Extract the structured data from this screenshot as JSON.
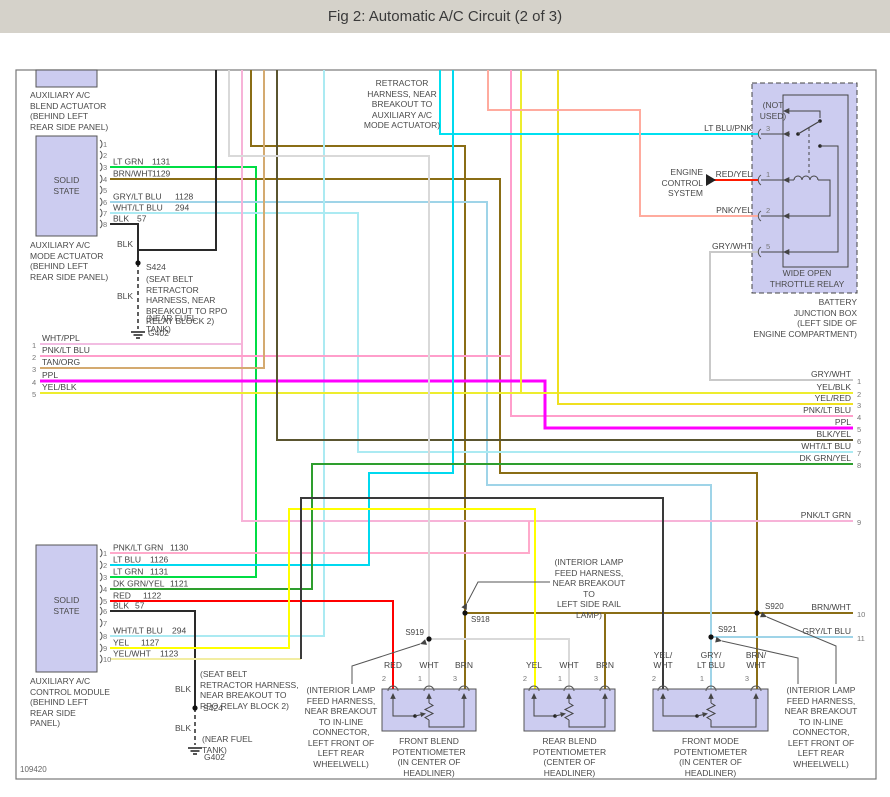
{
  "title": "Fig 2: Automatic A/C Circuit (2 of 3)",
  "doc_id": "109420",
  "colors": {
    "titlebar": "#d5d2ca",
    "box_fill": "#ccccf0",
    "box_border": "#555555",
    "text": "#4a4a4a",
    "frame": "#666666",
    "lt_grn": "#00dd44",
    "brn": "#8a6d15",
    "gry_lt_blu": "#9fd4e8",
    "wht_lt_blu": "#abeaf2",
    "blk": "#2a2a2a",
    "wht_ppl": "#f2bde2",
    "pnk_lt_blu": "#ff9ecb",
    "tan_org": "#d4aa70",
    "ppl": "#ff00ff",
    "yel_blk": "#eded2e",
    "yel_red": "#efe020",
    "blk_yel": "#5a5530",
    "gry_wht": "#c9c9c9",
    "lt_blu_pnk": "#00e0f0",
    "pnk_yel": "#ffab9e",
    "red": "#ff0000",
    "wht": "#d9d9d9",
    "lt_blu": "#00d9ef",
    "dk_grn_yel": "#2e9e2e",
    "yel": "#ffff00",
    "yel_wht": "#f2eda2",
    "pnk_lt_grn": "#ffaacb"
  },
  "components": {
    "blend_actuator": {
      "label": "AUXILIARY A/C\nBLEND ACTUATOR\n(BEHIND LEFT\nREAR SIDE PANEL)"
    },
    "mode_actuator": {
      "solid_state": "SOLID\nSTATE",
      "label": "AUXILIARY A/C\nMODE ACTUATOR\n(BEHIND LEFT\nREAR SIDE PANEL)",
      "pins": [
        {
          "n": "1",
          "y": 144,
          "label": "",
          "circuit": "",
          "cx": 0
        },
        {
          "n": "2",
          "y": 155,
          "label": "",
          "circuit": "",
          "cx": 0
        },
        {
          "n": "3",
          "y": 167,
          "label": "LT GRN",
          "circuit": "1131",
          "cx": 152
        },
        {
          "n": "4",
          "y": 179,
          "label": "BRN/WHT",
          "circuit": "1129",
          "cx": 152
        },
        {
          "n": "5",
          "y": 190,
          "label": "",
          "circuit": "",
          "cx": 0
        },
        {
          "n": "6",
          "y": 202,
          "label": "GRY/LT BLU",
          "circuit": "1128",
          "cx": 175
        },
        {
          "n": "7",
          "y": 213,
          "label": "WHT/LT BLU",
          "circuit": "294",
          "cx": 175
        },
        {
          "n": "8",
          "y": 224,
          "label": "BLK",
          "circuit": "57",
          "cx": 137
        }
      ]
    },
    "control_module": {
      "solid_state": "SOLID\nSTATE",
      "label": "AUXILIARY A/C\nCONTROL MODULE\n(BEHIND LEFT\nREAR SIDE\nPANEL)",
      "pins": [
        {
          "n": "1",
          "y": 553,
          "label": "PNK/LT GRN",
          "circuit": "1130",
          "cx": 170
        },
        {
          "n": "2",
          "y": 565,
          "label": "LT BLU",
          "circuit": "1126",
          "cx": 150
        },
        {
          "n": "3",
          "y": 577,
          "label": "LT GRN",
          "circuit": "1131",
          "cx": 150
        },
        {
          "n": "4",
          "y": 589,
          "label": "DK GRN/YEL",
          "circuit": "1121",
          "cx": 170
        },
        {
          "n": "5",
          "y": 601,
          "label": "RED",
          "circuit": "1122",
          "cx": 143
        },
        {
          "n": "6",
          "y": 611,
          "label": "BLK",
          "circuit": "57",
          "cx": 135
        },
        {
          "n": "7",
          "y": 623,
          "label": "",
          "circuit": "",
          "cx": 0
        },
        {
          "n": "8",
          "y": 636,
          "label": "WHT/LT BLU",
          "circuit": "294",
          "cx": 172
        },
        {
          "n": "9",
          "y": 648,
          "label": "YEL",
          "circuit": "1127",
          "cx": 141
        },
        {
          "n": "10",
          "y": 659,
          "label": "YEL/WHT",
          "circuit": "1123",
          "cx": 160
        }
      ]
    },
    "relay": {
      "name": "WIDE OPEN\nTHROTTLE RELAY",
      "location": "BATTERY\nJUNCTION BOX\n(LEFT SIDE OF\nENGINE COMPARTMENT)",
      "not_used": "(NOT\nUSED)",
      "pins": [
        {
          "n": "3",
          "y": 134,
          "label": "LT BLU/PNK"
        },
        {
          "n": "1",
          "y": 180,
          "label": "RED/YEL"
        },
        {
          "n": "2",
          "y": 216,
          "label": "PNK/YEL"
        },
        {
          "n": "5",
          "y": 252,
          "label": "GRY/WHT"
        }
      ]
    },
    "pots": [
      {
        "x": 382,
        "w": 94,
        "label": "FRONT BLEND\nPOTENTIOMETER\n(IN CENTER OF\nHEADLINER)",
        "pins": [
          {
            "n": "2",
            "x": 393,
            "label": "RED"
          },
          {
            "n": "1",
            "x": 429,
            "label": "WHT"
          },
          {
            "n": "3",
            "x": 464,
            "label": "BRN"
          }
        ]
      },
      {
        "x": 524,
        "w": 91,
        "label": "REAR BLEND\nPOTENTIOMETER\n(CENTER OF\nHEADLINER)",
        "pins": [
          {
            "n": "2",
            "x": 534,
            "label": "YEL"
          },
          {
            "n": "1",
            "x": 569,
            "label": "WHT"
          },
          {
            "n": "3",
            "x": 605,
            "label": "BRN"
          }
        ]
      },
      {
        "x": 653,
        "w": 115,
        "label": "FRONT MODE\nPOTENTIOMETER\n(IN CENTER OF\nHEADLINER)",
        "pins": [
          {
            "n": "2",
            "x": 663,
            "label": "YEL/\nWHT"
          },
          {
            "n": "1",
            "x": 711,
            "label": "GRY/\nLT BLU"
          },
          {
            "n": "3",
            "x": 756,
            "label": "BRN/\nWHT"
          }
        ]
      }
    ]
  },
  "notes": {
    "retractor": "RETRACTOR\nHARNESS, NEAR\nBREAKOUT TO\nAUXILIARY A/C\nMODE ACTUATOR)",
    "seatbelt_upper": "(SEAT BELT RETRACTOR\nHARNESS, NEAR\nBREAKOUT TO RPO\nRELAY BLOCK 2)",
    "seatbelt_lower": "(SEAT BELT\nRETRACTOR HARNESS,\nNEAR BREAKOUT TO\nRPO RELAY BLOCK 2)",
    "near_fuel_tank": "(NEAR FUEL\nTANK)",
    "interior_lamp_left": "(INTERIOR LAMP\nFEED HARNESS,\nNEAR BREAKOUT\nTO IN-LINE\nCONNECTOR,\nLEFT FRONT OF\nLEFT REAR\nWHEELWELL)",
    "interior_lamp_rail": "(INTERIOR LAMP\nFEED HARNESS,\nNEAR BREAKOUT TO\nLEFT SIDE RAIL\nLAMP)",
    "interior_lamp_right": "(INTERIOR LAMP\nFEED HARNESS,\nNEAR BREAKOUT\nTO IN-LINE\nCONNECTOR,\nLEFT FRONT OF\nLEFT REAR\nWHEELWELL)",
    "engine_control": "ENGINE\nCONTROL\nSYSTEM",
    "blk": "BLK",
    "s424": "S424",
    "g402": "G402"
  },
  "left_pins": [
    {
      "n": "1",
      "y": 344,
      "label": "WHT/PPL"
    },
    {
      "n": "2",
      "y": 356,
      "label": "PNK/LT BLU"
    },
    {
      "n": "3",
      "y": 368,
      "label": "TAN/ORG"
    },
    {
      "n": "4",
      "y": 381,
      "label": "PPL"
    },
    {
      "n": "5",
      "y": 393,
      "label": "YEL/BLK"
    }
  ],
  "right_pins": [
    {
      "n": "1",
      "y": 380,
      "label": "GRY/WHT"
    },
    {
      "n": "2",
      "y": 393,
      "label": "YEL/BLK"
    },
    {
      "n": "3",
      "y": 404,
      "label": "YEL/RED"
    },
    {
      "n": "4",
      "y": 416,
      "label": "PNK/LT BLU"
    },
    {
      "n": "5",
      "y": 428,
      "label": "PPL"
    },
    {
      "n": "6",
      "y": 440,
      "label": "BLK/YEL"
    },
    {
      "n": "7",
      "y": 452,
      "label": "WHT/LT BLU"
    },
    {
      "n": "8",
      "y": 464,
      "label": "DK GRN/YEL"
    },
    {
      "n": "9",
      "y": 521,
      "label": "PNK/LT GRN"
    },
    {
      "n": "10",
      "y": 613,
      "label": "BRN/WHT"
    },
    {
      "n": "11",
      "y": 637,
      "label": "GRY/LT BLU"
    }
  ],
  "splices": [
    {
      "id": "S919",
      "x": 429,
      "y": 639,
      "lx": 424,
      "ly": 635,
      "anchor": "end"
    },
    {
      "id": "S918",
      "x": 465,
      "y": 613,
      "lx": 471,
      "ly": 622,
      "anchor": "start"
    },
    {
      "id": "S920",
      "x": 757,
      "y": 613,
      "lx": 765,
      "ly": 609,
      "anchor": "start"
    },
    {
      "id": "S921",
      "x": 711,
      "y": 637,
      "lx": 718,
      "ly": 632,
      "anchor": "start"
    },
    {
      "id": "S424",
      "x": 138,
      "y": 263,
      "lx": 0,
      "ly": 0,
      "anchor": "none"
    },
    {
      "id": "S424",
      "x": 195,
      "y": 708,
      "lx": 0,
      "ly": 0,
      "anchor": "none"
    }
  ],
  "grounds": [
    {
      "id": "G402",
      "x": 138,
      "y": 332
    },
    {
      "id": "G402",
      "x": 195,
      "y": 748
    }
  ],
  "wires": [
    {
      "name": "lt-grn-1131",
      "color": "#00dd44",
      "w": 2,
      "pts": [
        [
          110,
          167
        ],
        [
          256,
          167
        ],
        [
          256,
          577
        ],
        [
          110,
          577
        ]
      ]
    },
    {
      "name": "brn-retractor",
      "color": "#8a6d15",
      "w": 2,
      "pts": [
        [
          251,
          70
        ],
        [
          251,
          146
        ],
        [
          465,
          146
        ],
        [
          465,
          689
        ]
      ]
    },
    {
      "name": "brn-wht-1129",
      "color": "#8a6d15",
      "w": 2,
      "pts": [
        [
          110,
          179
        ],
        [
          500,
          179
        ],
        [
          500,
          473
        ],
        [
          757,
          473
        ],
        [
          757,
          689
        ]
      ]
    },
    {
      "name": "brn-splice-bus",
      "color": "#8a6d15",
      "w": 2,
      "pts": [
        [
          465,
          613
        ],
        [
          757,
          613
        ]
      ]
    },
    {
      "name": "brn-pot2",
      "color": "#8a6d15",
      "w": 2,
      "pts": [
        [
          605,
          613
        ],
        [
          605,
          689
        ]
      ]
    },
    {
      "name": "brn-wht-pin10",
      "color": "#8a6d15",
      "w": 2,
      "pts": [
        [
          757,
          613
        ],
        [
          853,
          613
        ]
      ]
    },
    {
      "name": "gry-lt-blu-1128",
      "color": "#9fd4e8",
      "w": 2,
      "pts": [
        [
          110,
          202
        ],
        [
          487,
          202
        ],
        [
          487,
          485
        ],
        [
          711,
          485
        ],
        [
          711,
          689
        ]
      ]
    },
    {
      "name": "gry-lt-blu-pin11",
      "color": "#9fd4e8",
      "w": 2,
      "pts": [
        [
          711,
          637
        ],
        [
          853,
          637
        ]
      ]
    },
    {
      "name": "wht-lt-blu-294-top",
      "color": "#abeaf2",
      "w": 2,
      "pts": [
        [
          110,
          213
        ],
        [
          358,
          213
        ],
        [
          358,
          452
        ],
        [
          853,
          452
        ]
      ]
    },
    {
      "name": "wht-lt-blu-294-module",
      "color": "#abeaf2",
      "w": 2,
      "pts": [
        [
          324,
          70
        ],
        [
          324,
          636
        ],
        [
          110,
          636
        ]
      ]
    },
    {
      "name": "blk-57-mode",
      "color": "#2a2a2a",
      "w": 2,
      "pts": [
        [
          110,
          224
        ],
        [
          138,
          224
        ],
        [
          138,
          263
        ]
      ]
    },
    {
      "name": "blk-blend",
      "color": "#2a2a2a",
      "w": 2,
      "pts": [
        [
          216,
          70
        ],
        [
          216,
          250
        ],
        [
          138,
          250
        ],
        [
          138,
          263
        ]
      ]
    },
    {
      "name": "blk-to-g402-rear",
      "color": "#2a2a2a",
      "w": 1.5,
      "dash": "4 3",
      "pts": [
        [
          138,
          263
        ],
        [
          138,
          329
        ]
      ]
    },
    {
      "name": "wht-ppl",
      "color": "#f2bde2",
      "w": 2,
      "pts": [
        [
          40,
          344
        ],
        [
          242,
          344
        ]
      ]
    },
    {
      "name": "wht-ppl-vert-pin9",
      "color": "#f7b3d8",
      "w": 2,
      "pts": [
        [
          242,
          70
        ],
        [
          242,
          521
        ],
        [
          853,
          521
        ]
      ]
    },
    {
      "name": "pnk-lt-grn-1130",
      "color": "#ffaacb",
      "w": 2,
      "pts": [
        [
          110,
          553
        ],
        [
          529,
          553
        ],
        [
          529,
          521
        ]
      ]
    },
    {
      "name": "pnk-lt-blu",
      "color": "#ff9ecb",
      "w": 2,
      "pts": [
        [
          40,
          356
        ],
        [
          511,
          356
        ],
        [
          511,
          416
        ],
        [
          853,
          416
        ]
      ]
    },
    {
      "name": "pnk-lt-blu-vert",
      "color": "#ff9ecb",
      "w": 2,
      "pts": [
        [
          511,
          70
        ],
        [
          511,
          356
        ]
      ]
    },
    {
      "name": "tan-org",
      "color": "#d4aa70",
      "w": 2,
      "pts": [
        [
          40,
          368
        ],
        [
          264,
          368
        ],
        [
          264,
          70
        ]
      ]
    },
    {
      "name": "ppl",
      "color": "#ff00ff",
      "w": 3,
      "pts": [
        [
          40,
          381
        ],
        [
          545,
          381
        ],
        [
          545,
          428
        ],
        [
          853,
          428
        ]
      ]
    },
    {
      "name": "yel-blk",
      "color": "#eded2e",
      "w": 2,
      "pts": [
        [
          40,
          393
        ],
        [
          853,
          393
        ]
      ]
    },
    {
      "name": "yel-blk-vert",
      "color": "#eded2e",
      "w": 2,
      "pts": [
        [
          521,
          70
        ],
        [
          521,
          393
        ]
      ]
    },
    {
      "name": "yel-red",
      "color": "#efe020",
      "w": 2,
      "pts": [
        [
          558,
          70
        ],
        [
          558,
          404
        ],
        [
          853,
          404
        ]
      ]
    },
    {
      "name": "blk-yel",
      "color": "#5a5530",
      "w": 2,
      "pts": [
        [
          277,
          70
        ],
        [
          277,
          440
        ],
        [
          853,
          440
        ]
      ]
    },
    {
      "name": "gry-wht-relay",
      "color": "#c9c9c9",
      "w": 2,
      "pts": [
        [
          758,
          252
        ],
        [
          710,
          252
        ],
        [
          710,
          380
        ],
        [
          853,
          380
        ]
      ]
    },
    {
      "name": "lt-blu-pnk",
      "color": "#00e0f0",
      "w": 2,
      "pts": [
        [
          440,
          70
        ],
        [
          440,
          134
        ],
        [
          758,
          134
        ]
      ]
    },
    {
      "name": "pnk-yel",
      "color": "#ffab9e",
      "w": 2,
      "pts": [
        [
          488,
          70
        ],
        [
          488,
          110
        ],
        [
          640,
          110
        ],
        [
          640,
          216
        ],
        [
          758,
          216
        ]
      ]
    },
    {
      "name": "red-yel",
      "color": "#ff1a00",
      "w": 2,
      "pts": [
        [
          714,
          180
        ],
        [
          758,
          180
        ]
      ]
    },
    {
      "name": "wht-s919-pot1",
      "color": "#d9d9d9",
      "w": 2,
      "pts": [
        [
          229,
          70
        ],
        [
          229,
          156
        ],
        [
          429,
          156
        ],
        [
          429,
          689
        ]
      ]
    },
    {
      "name": "wht-s919-pot2",
      "color": "#d9d9d9",
      "w": 2,
      "pts": [
        [
          429,
          639
        ],
        [
          569,
          639
        ],
        [
          569,
          689
        ]
      ]
    },
    {
      "name": "lt-blu-1126",
      "color": "#00d9ef",
      "w": 2,
      "pts": [
        [
          110,
          565
        ],
        [
          369,
          565
        ],
        [
          369,
          473
        ],
        [
          453,
          473
        ],
        [
          453,
          70
        ]
      ]
    },
    {
      "name": "dk-grn-yel-1121",
      "color": "#2e9e2e",
      "w": 2,
      "pts": [
        [
          110,
          589
        ],
        [
          312,
          589
        ],
        [
          312,
          464
        ],
        [
          853,
          464
        ]
      ]
    },
    {
      "name": "red-1122",
      "color": "#ff0000",
      "w": 2,
      "pts": [
        [
          110,
          601
        ],
        [
          393,
          601
        ],
        [
          393,
          689
        ]
      ]
    },
    {
      "name": "blk-57-module",
      "color": "#2a2a2a",
      "w": 2,
      "pts": [
        [
          110,
          611
        ],
        [
          195,
          611
        ],
        [
          195,
          708
        ]
      ]
    },
    {
      "name": "blk-to-g402-fuel",
      "color": "#2a2a2a",
      "w": 1.5,
      "dash": "4 3",
      "pts": [
        [
          195,
          708
        ],
        [
          195,
          745
        ]
      ]
    },
    {
      "name": "yel-1127",
      "color": "#ffff00",
      "w": 2,
      "pts": [
        [
          110,
          648
        ],
        [
          289,
          648
        ],
        [
          289,
          509
        ],
        [
          535,
          509
        ],
        [
          535,
          689
        ]
      ]
    },
    {
      "name": "yel-wht-1123",
      "color": "#f2eda2",
      "w": 2,
      "pts": [
        [
          110,
          659
        ],
        [
          301,
          659
        ]
      ]
    },
    {
      "name": "yel-wht-1123-cont",
      "color": "#3a3a3a",
      "w": 2,
      "pts": [
        [
          301,
          659
        ],
        [
          301,
          498
        ],
        [
          663,
          498
        ],
        [
          663,
          689
        ]
      ]
    }
  ],
  "pointers": [
    {
      "to": "S919",
      "pts": [
        [
          352,
          684
        ],
        [
          352,
          666
        ],
        [
          420,
          644
        ]
      ]
    },
    {
      "to": "S918",
      "pts": [
        [
          550,
          582
        ],
        [
          478,
          582
        ],
        [
          467,
          603
        ]
      ]
    },
    {
      "to": "S921",
      "pts": [
        [
          798,
          684
        ],
        [
          798,
          658
        ],
        [
          722,
          641
        ]
      ]
    },
    {
      "to": "S920",
      "pts": [
        [
          836,
          684
        ],
        [
          836,
          646
        ],
        [
          767,
          617
        ]
      ]
    }
  ]
}
